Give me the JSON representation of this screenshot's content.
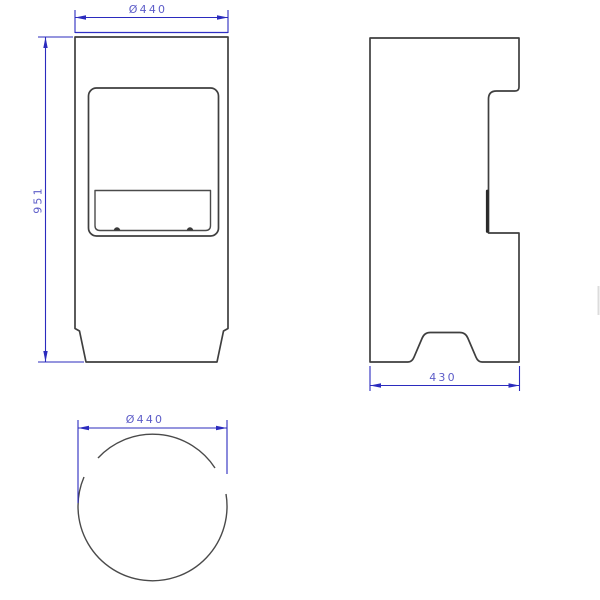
{
  "page": {
    "background": "#ffffff"
  },
  "drawing": {
    "kind": "technical-drawing-three-views",
    "line_color": "#3f3f3f",
    "dimension_line_color": "#2b2bbe",
    "dimension_text_color": "#5c5cc8",
    "dimensions": {
      "front_width": "Ø440",
      "front_height": "951",
      "side_depth": "430",
      "bottom_diameter": "Ø440"
    }
  }
}
